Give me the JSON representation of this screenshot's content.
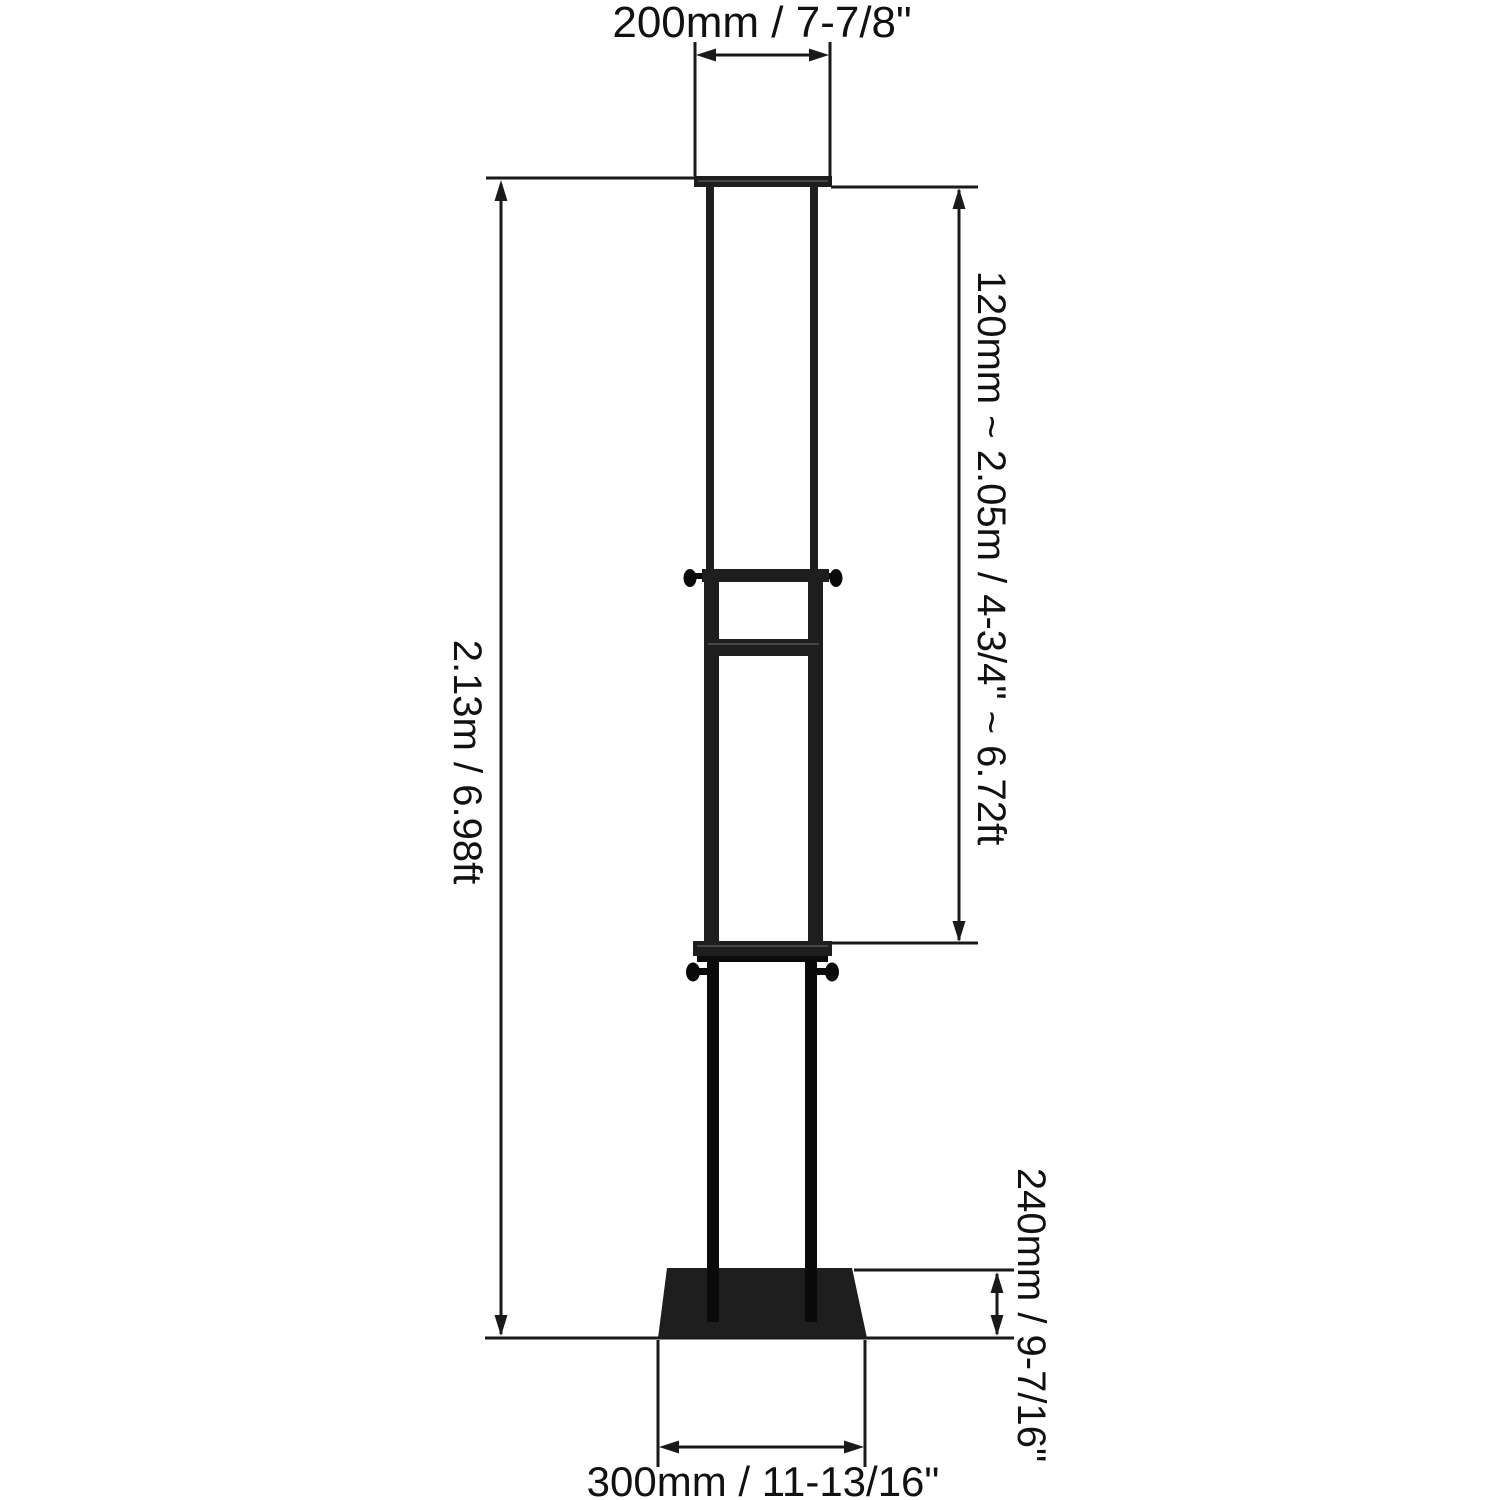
{
  "colors": {
    "background": "#ffffff",
    "line": "#1a1a1a",
    "text": "#111111",
    "metal": "#1e1e1e",
    "metal_dark": "#0a0a0a",
    "metal_highlight": "#454545"
  },
  "dimensions": {
    "top_width": "200mm / 7-7/8\"",
    "overall_height": "2.13m / 6.98ft",
    "adjustable_height": "120mm ~ 2.05m / 4-3/4\" ~ 6.72ft",
    "base_depth": "240mm / 9-7/16\"",
    "base_width": "300mm / 11-13/16\""
  }
}
